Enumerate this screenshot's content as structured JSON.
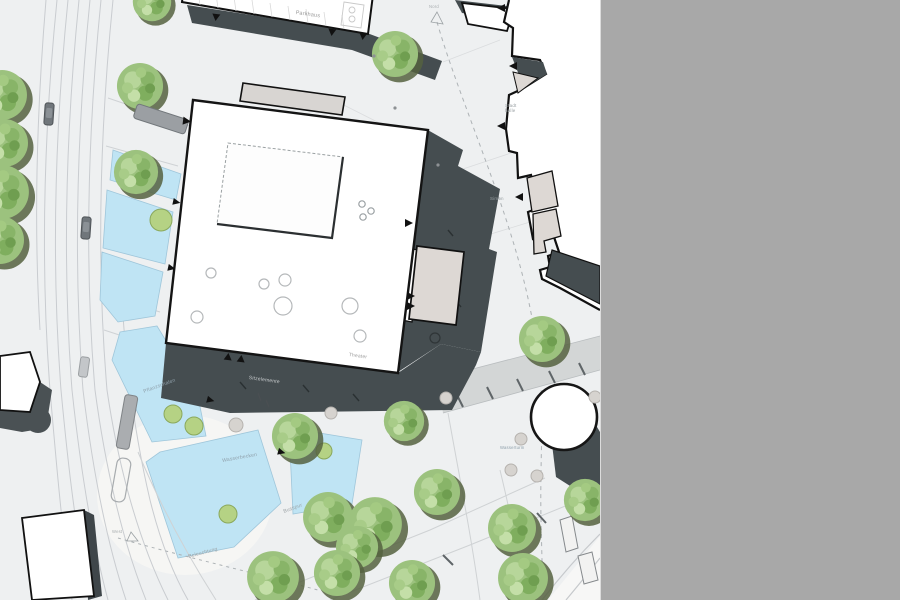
{
  "canvas": {
    "width": 900,
    "height": 600,
    "background": "#ffffff"
  },
  "side_panel": {
    "color": "#a8a8a8"
  },
  "plan": {
    "type": "architectural-site-plan",
    "labels": {
      "parkhaus": {
        "text": "Parkhaus"
      },
      "stadthalle": {
        "text": "Stadt\nhalle"
      },
      "simon": {
        "text": "Simon"
      },
      "theater": {
        "text": "Theater"
      },
      "sitzelemente": {
        "text": "Sitzelemente"
      },
      "pflanzschalen": {
        "text": "Pflanzschalen"
      },
      "wasserbecken": {
        "text": "Wasserbecken"
      },
      "busspur": {
        "text": "Busspur"
      },
      "beleuchtung": {
        "text": "Beleuchtung"
      },
      "wasserturm": {
        "text": "Wasserturm"
      },
      "nord": {
        "text": "Nord"
      },
      "west": {
        "text": "West"
      }
    },
    "palette": {
      "background": "#eef0f1",
      "water": "#bfe4f4",
      "water_edge": "#9fc6da",
      "tree_foliage": "#9cc27e",
      "tree_shadow": "#55623f",
      "planter_green": "#b5d284",
      "building_white": "#ffffff",
      "building_outline": "#141414",
      "shadow_dark": "#454d50",
      "annex_beige": "#ddd8d4",
      "annex_gray": "#d8d5d2",
      "road_line": "#c9ccd0",
      "street_band": "#d3d6d6",
      "label_gray": "#9aa1a4",
      "label_blue": "#8fa0ab"
    }
  }
}
